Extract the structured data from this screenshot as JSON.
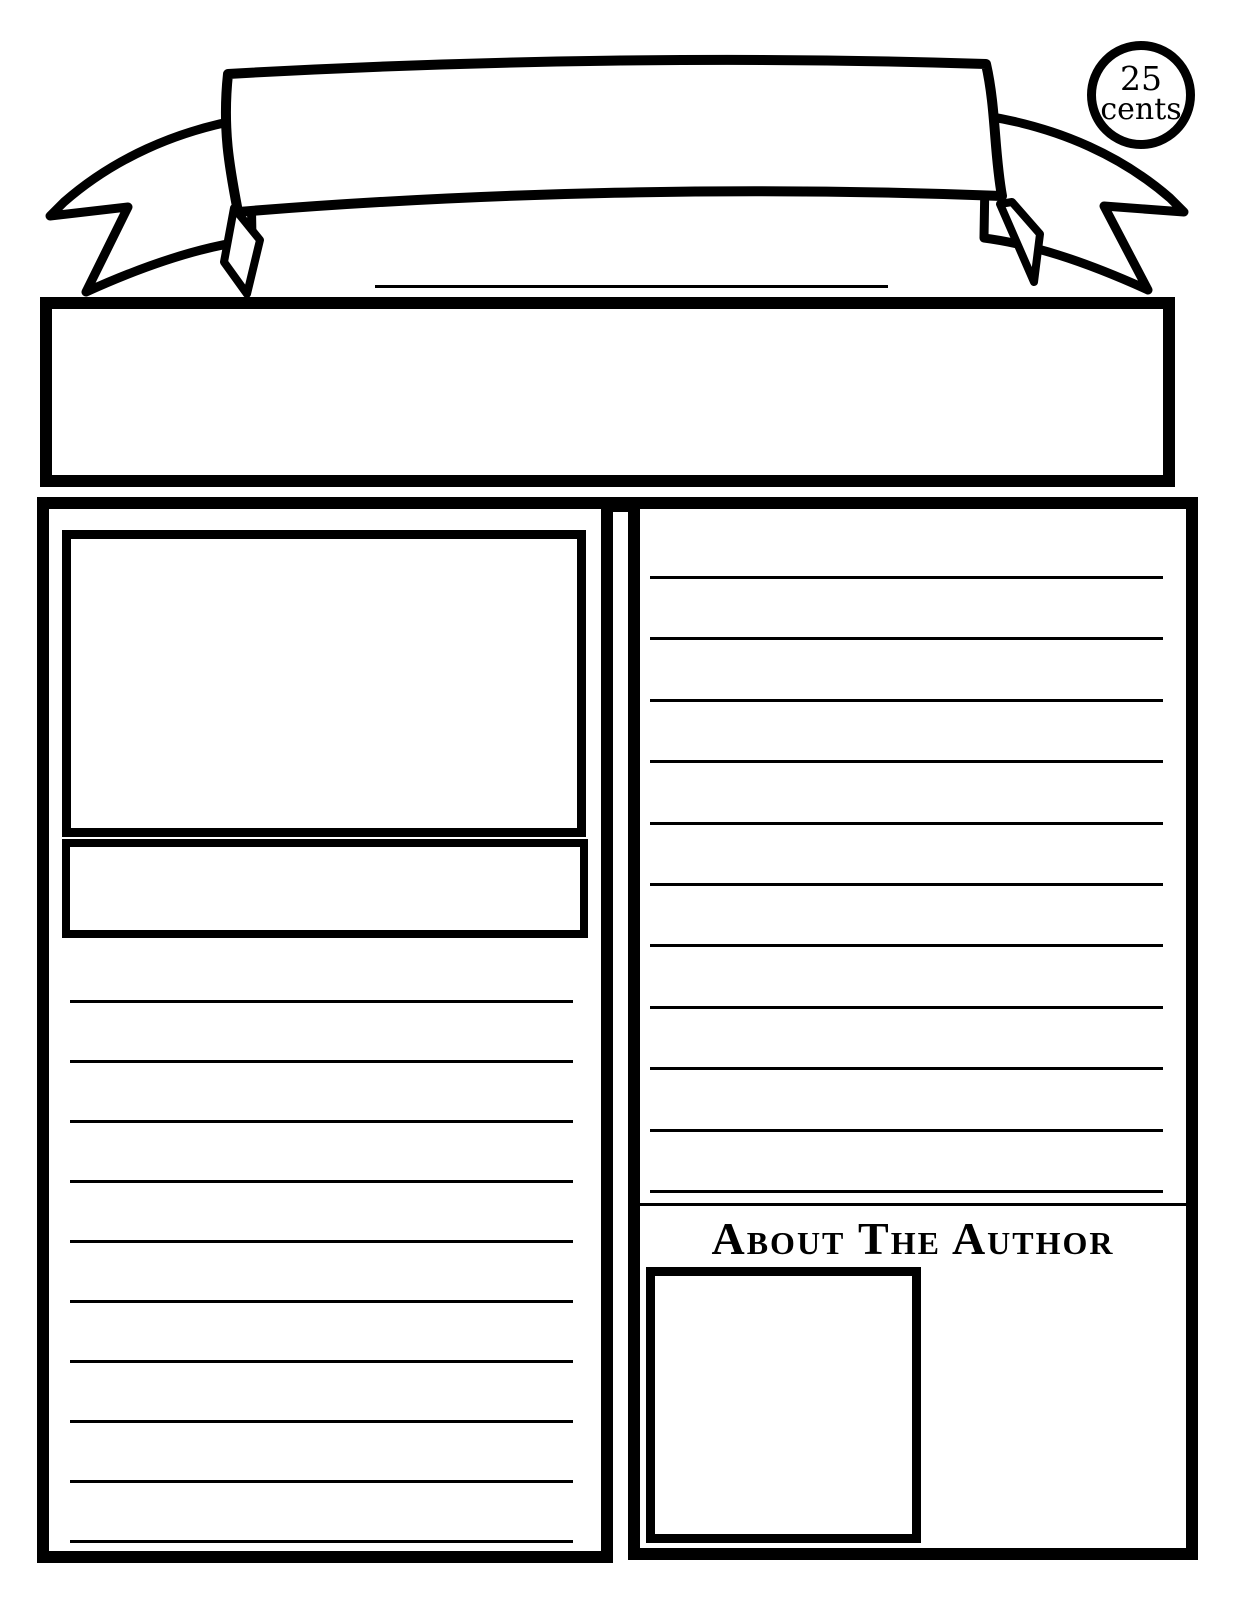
{
  "price_badge": {
    "line1": "25",
    "line2": "cents"
  },
  "banner": {
    "title_value": ""
  },
  "headline_box": {
    "value": ""
  },
  "left_column": {
    "ruled_line_count": 10,
    "photo_value": "",
    "caption_value": ""
  },
  "right_column": {
    "about_heading": "About The Author",
    "ruled_line_count": 11
  },
  "colors": {
    "ink": "#000000",
    "paper": "#ffffff"
  }
}
